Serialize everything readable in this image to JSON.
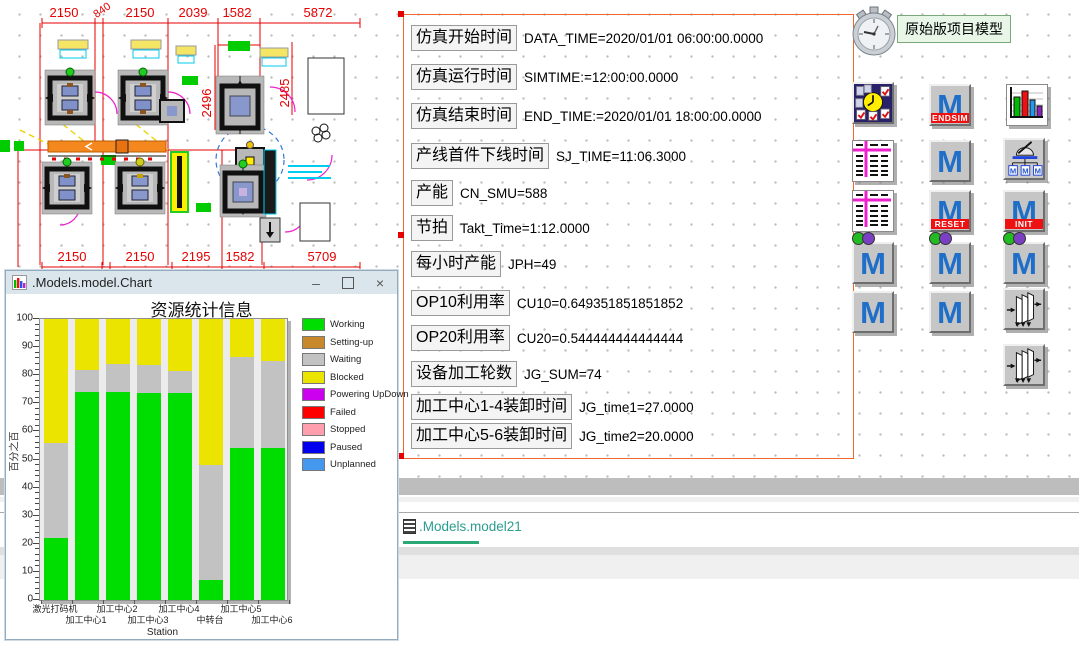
{
  "cad": {
    "top_dims": [
      "2150",
      "840",
      "2150",
      "2039",
      "1582",
      "5872"
    ],
    "bottom_dims": [
      "2150",
      "2150",
      "2195",
      "1582",
      "5709"
    ],
    "side_dims": [
      "2496",
      "2485"
    ]
  },
  "model_badge": {
    "label": "原始版项目模型"
  },
  "info_panel": {
    "rows": [
      {
        "label": "仿真开始时间",
        "value": "DATA_TIME=2020/01/01 06:00:00.0000"
      },
      {
        "label": "仿真运行时间",
        "value": "SIMTIME:=12:00:00.0000"
      },
      {
        "label": "仿真结束时间",
        "value": "END_TIME:=2020/01/01 18:00:00.0000"
      },
      {
        "label": "产线首件下线时间",
        "value": "SJ_TIME=11:06.3000"
      },
      {
        "label": "产能",
        "value": "CN_SMU=588"
      },
      {
        "label": "节拍",
        "value": "Takt_Time=1:12.0000"
      },
      {
        "label": "每小时产能",
        "value": "JPH=49"
      },
      {
        "label": "OP10利用率",
        "value": "CU10=0.649351851851852"
      },
      {
        "label": "OP20利用率",
        "value": "CU20=0.544444444444444"
      },
      {
        "label": "设备加工轮数",
        "value": "JG_SUM=74"
      },
      {
        "label": "加工中心1-4装卸时间",
        "value": "JG_time1=27.0000"
      },
      {
        "label": "加工中心5-6装卸时间",
        "value": "JG_time2=20.0000"
      }
    ]
  },
  "icons": {
    "m_letter": "M",
    "toolbox": [
      {
        "name": "experiment-tool-icon",
        "type": "experiment"
      },
      {
        "name": "method-endsim-button",
        "type": "method",
        "badge": "ENDSIM"
      },
      {
        "name": "chart-tool-icon",
        "type": "chart"
      },
      {
        "name": "table-file-icon-1",
        "type": "table"
      },
      {
        "name": "method-button-1",
        "type": "method"
      },
      {
        "name": "method-hierarchy-icon",
        "type": "mmm"
      },
      {
        "name": "table-file-icon-2",
        "type": "table"
      },
      {
        "name": "method-reset-button",
        "type": "method",
        "badge": "RESET"
      },
      {
        "name": "method-init-button",
        "type": "method",
        "badge": "INIT"
      },
      {
        "name": "method-dots-button-1",
        "type": "method",
        "dots": true
      },
      {
        "name": "method-dots-button-2",
        "type": "method",
        "dots": true
      },
      {
        "name": "method-dots-button-3",
        "type": "method",
        "dots": true
      },
      {
        "name": "method-button-2",
        "type": "method"
      },
      {
        "name": "method-button-3",
        "type": "method"
      },
      {
        "name": "flow-control-icon-1",
        "type": "flow"
      },
      {
        "name": "flow-control-icon-2",
        "type": "flow"
      }
    ]
  },
  "chart_window": {
    "title": ".Models.model.Chart",
    "minimize_glyph": "–",
    "close_glyph": "×"
  },
  "tab": {
    "label": ".Models.model21"
  },
  "chart_data": {
    "type": "bar",
    "stacked": true,
    "title": "资源统计信息",
    "xlabel": "Station",
    "ylabel": "百分之百",
    "ylim": [
      0,
      100
    ],
    "y_ticks": [
      0,
      10,
      20,
      30,
      40,
      50,
      60,
      70,
      80,
      90,
      100
    ],
    "grid": false,
    "legend_position": "right",
    "categories": [
      "激光打码机",
      "加工中心1",
      "加工中心2",
      "加工中心3",
      "加工中心4",
      "中转台",
      "加工中心5",
      "加工中心6"
    ],
    "series": [
      {
        "name": "Working",
        "color": "#00dd00",
        "values": [
          22,
          74,
          74,
          73.5,
          73.5,
          7,
          54,
          54
        ]
      },
      {
        "name": "Setting-up",
        "color": "#c8882c",
        "values": [
          0,
          0,
          0,
          0,
          0,
          0,
          0,
          0
        ]
      },
      {
        "name": "Waiting",
        "color": "#c2c2c2",
        "values": [
          34,
          8,
          10,
          10,
          8,
          41,
          32.5,
          31
        ]
      },
      {
        "name": "Blocked",
        "color": "#ebe300",
        "values": [
          44,
          18,
          16,
          16.5,
          18.5,
          52,
          13.5,
          15
        ]
      },
      {
        "name": "Powering UpDown",
        "color": "#cc00ee",
        "values": [
          0,
          0,
          0,
          0,
          0,
          0,
          0,
          0
        ]
      },
      {
        "name": "Failed",
        "color": "#ff0000",
        "values": [
          0,
          0,
          0,
          0,
          0,
          0,
          0,
          0
        ]
      },
      {
        "name": "Stopped",
        "color": "#ff9fae",
        "values": [
          0,
          0,
          0,
          0,
          0,
          0,
          0,
          0
        ]
      },
      {
        "name": "Paused",
        "color": "#0000ee",
        "values": [
          0,
          0,
          0,
          0,
          0,
          0,
          0,
          0
        ]
      },
      {
        "name": "Unplanned",
        "color": "#4499ee",
        "values": [
          0,
          0,
          0,
          0,
          0,
          0,
          0,
          0
        ]
      }
    ]
  }
}
